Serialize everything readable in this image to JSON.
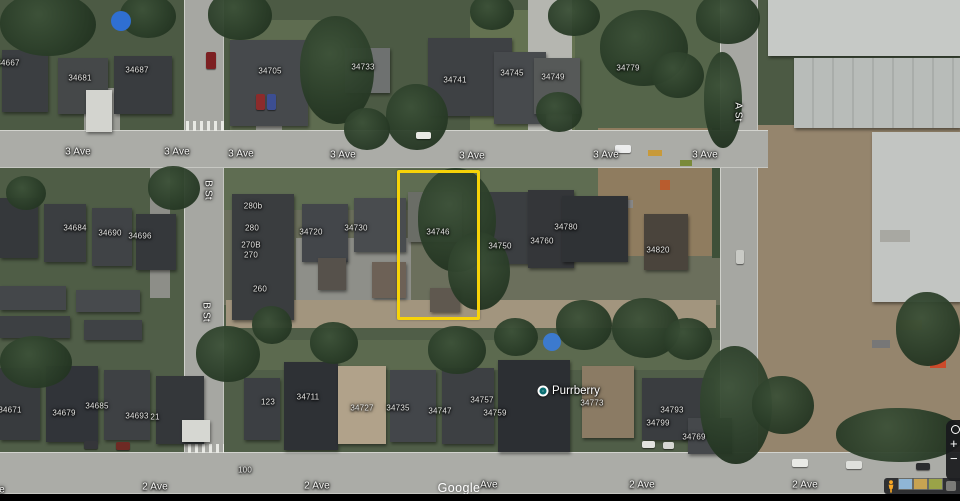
{
  "map": {
    "street_labels": [
      {
        "text": "3 Ave",
        "x": 78,
        "y": 152
      },
      {
        "text": "3 Ave",
        "x": 177,
        "y": 152
      },
      {
        "text": "3 Ave",
        "x": 241,
        "y": 154
      },
      {
        "text": "3 Ave",
        "x": 343,
        "y": 155
      },
      {
        "text": "3 Ave",
        "x": 472,
        "y": 156
      },
      {
        "text": "3 Ave",
        "x": 606,
        "y": 155
      },
      {
        "text": "3 Ave",
        "x": 705,
        "y": 155
      },
      {
        "text": "2 Ave",
        "x": -8,
        "y": 490
      },
      {
        "text": "2 Ave",
        "x": 155,
        "y": 487
      },
      {
        "text": "2 Ave",
        "x": 317,
        "y": 486
      },
      {
        "text": "Ave",
        "x": 489,
        "y": 485
      },
      {
        "text": "2 Ave",
        "x": 642,
        "y": 485
      },
      {
        "text": "2 Ave",
        "x": 805,
        "y": 485
      },
      {
        "text": "B St",
        "x": 208,
        "y": 190,
        "vertical": true
      },
      {
        "text": "B St",
        "x": 206,
        "y": 312,
        "vertical": true
      },
      {
        "text": "A St",
        "x": 738,
        "y": 112,
        "vertical": true
      }
    ],
    "address_labels": [
      {
        "text": "34667",
        "x": 8,
        "y": 63
      },
      {
        "text": "34681",
        "x": 80,
        "y": 78
      },
      {
        "text": "34687",
        "x": 137,
        "y": 70
      },
      {
        "text": "34705",
        "x": 270,
        "y": 71
      },
      {
        "text": "34733",
        "x": 363,
        "y": 67
      },
      {
        "text": "34741",
        "x": 455,
        "y": 80
      },
      {
        "text": "34745",
        "x": 512,
        "y": 73
      },
      {
        "text": "34749",
        "x": 553,
        "y": 77
      },
      {
        "text": "34779",
        "x": 628,
        "y": 68
      },
      {
        "text": "34684",
        "x": 75,
        "y": 228
      },
      {
        "text": "34690",
        "x": 110,
        "y": 233
      },
      {
        "text": "34696",
        "x": 140,
        "y": 236
      },
      {
        "text": "280b",
        "x": 253,
        "y": 206
      },
      {
        "text": "280",
        "x": 252,
        "y": 228
      },
      {
        "text": "270B",
        "x": 251,
        "y": 245
      },
      {
        "text": "270",
        "x": 251,
        "y": 255
      },
      {
        "text": "260",
        "x": 260,
        "y": 289
      },
      {
        "text": "34720",
        "x": 311,
        "y": 232
      },
      {
        "text": "34730",
        "x": 356,
        "y": 228
      },
      {
        "text": "34746",
        "x": 438,
        "y": 232
      },
      {
        "text": "34750",
        "x": 500,
        "y": 246
      },
      {
        "text": "34760",
        "x": 542,
        "y": 241
      },
      {
        "text": "34780",
        "x": 566,
        "y": 227
      },
      {
        "text": "34820",
        "x": 658,
        "y": 250
      },
      {
        "text": "34671",
        "x": 10,
        "y": 410
      },
      {
        "text": "34679",
        "x": 64,
        "y": 413
      },
      {
        "text": "34685",
        "x": 97,
        "y": 406
      },
      {
        "text": "34693",
        "x": 137,
        "y": 416
      },
      {
        "text": "21",
        "x": 155,
        "y": 417
      },
      {
        "text": "123",
        "x": 268,
        "y": 402
      },
      {
        "text": "34711",
        "x": 308,
        "y": 397
      },
      {
        "text": "34727",
        "x": 362,
        "y": 408
      },
      {
        "text": "34735",
        "x": 398,
        "y": 408
      },
      {
        "text": "34747",
        "x": 440,
        "y": 411
      },
      {
        "text": "34757",
        "x": 482,
        "y": 400
      },
      {
        "text": "34759",
        "x": 495,
        "y": 413
      },
      {
        "text": "34773",
        "x": 592,
        "y": 403
      },
      {
        "text": "34793",
        "x": 672,
        "y": 410
      },
      {
        "text": "34799",
        "x": 658,
        "y": 423
      },
      {
        "text": "34769",
        "x": 694,
        "y": 437
      },
      {
        "text": "100",
        "x": 245,
        "y": 470
      }
    ],
    "poi": {
      "name": "Purrberry",
      "x": 543,
      "y": 391
    },
    "highlight_box": {
      "x": 397,
      "y": 170,
      "width": 77,
      "height": 144,
      "color": "#F7D308"
    },
    "watermark": {
      "text": "Google",
      "x": 459,
      "y": 488
    }
  },
  "controls": {
    "zoom_in_label": "+",
    "zoom_out_label": "−",
    "thumbnails": [
      {
        "color": "#8FB6D6"
      },
      {
        "color": "#C8A352"
      },
      {
        "color": "#9AA348"
      }
    ]
  },
  "colors": {
    "highlight": "#F7D308",
    "road": "#ABACA7",
    "poi_dot": "#0B6E72",
    "pegman": "#F9A825"
  }
}
